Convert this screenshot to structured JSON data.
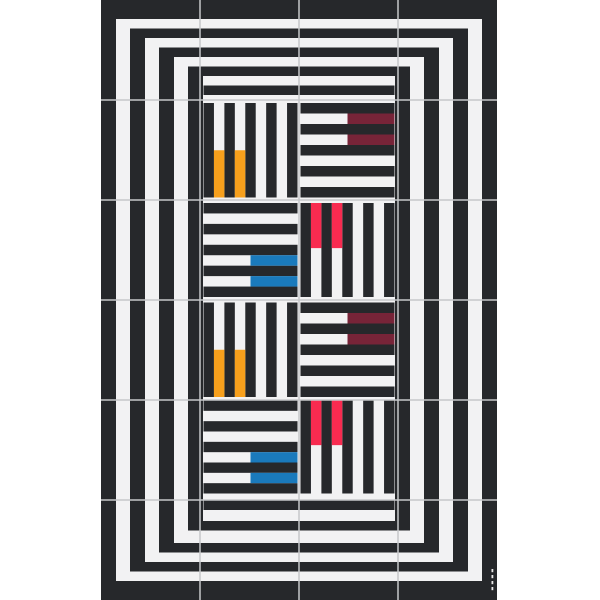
{
  "page": {
    "background": "#ffffff"
  },
  "artwork": {
    "left": 101,
    "top": 0,
    "width": 396,
    "height": 600,
    "colors": {
      "black": "#26282b",
      "white": "#f2f2f3",
      "seam": "#c6c8ca",
      "orange": "#f7a01c",
      "maroon": "#772438",
      "blue": "#1a7abc",
      "red": "#f82b50"
    },
    "grid": {
      "cols": 4,
      "rows": 6,
      "col_lines": [
        99,
        198,
        297
      ],
      "row_lines": [
        100,
        200,
        300,
        400,
        500
      ],
      "seam_width": 1.5
    },
    "frames": [
      {
        "x0": 0,
        "x1": 396,
        "y0": 0,
        "y1": 600,
        "leg_w": 15,
        "h_top": 19,
        "h_bot": 19
      },
      {
        "x0": 29,
        "x1": 367,
        "y0": 28.5,
        "y1": 571.5,
        "leg_w": 15,
        "h_top": 9.5,
        "h_bot": 9.5
      },
      {
        "x0": 58,
        "x1": 338,
        "y0": 47.5,
        "y1": 552.5,
        "leg_w": 15,
        "h_top": 9.5,
        "h_bot": 9.5
      },
      {
        "x0": 87,
        "x1": 309,
        "y0": 66.5,
        "y1": 530.5,
        "leg_w": 15,
        "h_top": 9.5,
        "h_bot": 9.5
      },
      {
        "x0": 102.5,
        "x1": 293.5,
        "y0": 85.5,
        "y1": 510,
        "leg_w": 0,
        "h_top": 9.5,
        "h_bot": 9.5
      }
    ],
    "tiles": [
      {
        "x": 102.5,
        "y": 103,
        "w": 94,
        "h": 94.5,
        "dir": "v",
        "bands": 9,
        "accent": {
          "color": "orange",
          "bands": [
            1,
            3
          ],
          "from": 0.5,
          "to": 1
        }
      },
      {
        "x": 199.5,
        "y": 103,
        "w": 94,
        "h": 94.5,
        "dir": "h",
        "bands": 9,
        "accent": {
          "color": "maroon",
          "bands": [
            1,
            3
          ],
          "from": 0.5,
          "to": 1
        }
      },
      {
        "x": 102.5,
        "y": 203,
        "w": 94,
        "h": 94,
        "dir": "h",
        "bands": 9,
        "accent": {
          "color": "blue",
          "bands": [
            5,
            7
          ],
          "from": 0.5,
          "to": 1
        }
      },
      {
        "x": 199.5,
        "y": 203,
        "w": 94,
        "h": 94,
        "dir": "v",
        "bands": 9,
        "accent": {
          "color": "red",
          "bands": [
            1,
            3
          ],
          "from": 0,
          "to": 0.48
        }
      },
      {
        "x": 102.5,
        "y": 302.5,
        "w": 94,
        "h": 94.5,
        "dir": "v",
        "bands": 9,
        "accent": {
          "color": "orange",
          "bands": [
            1,
            3
          ],
          "from": 0.5,
          "to": 1
        }
      },
      {
        "x": 199.5,
        "y": 302.5,
        "w": 94,
        "h": 94.5,
        "dir": "h",
        "bands": 9,
        "accent": {
          "color": "maroon",
          "bands": [
            1,
            3
          ],
          "from": 0.5,
          "to": 1
        }
      },
      {
        "x": 102.5,
        "y": 400.5,
        "w": 94,
        "h": 93,
        "dir": "h",
        "bands": 9,
        "accent": {
          "color": "blue",
          "bands": [
            5,
            7
          ],
          "from": 0.5,
          "to": 1
        }
      },
      {
        "x": 199.5,
        "y": 400.5,
        "w": 94,
        "h": 93,
        "dir": "v",
        "bands": 9,
        "accent": {
          "color": "red",
          "bands": [
            1,
            3
          ],
          "from": 0,
          "to": 0.48
        }
      }
    ],
    "signature": {
      "x": 390.5,
      "y": 569,
      "marks": 4,
      "gap": 6,
      "mark_w": 1.8,
      "mark_h": 3.2,
      "color": "#e9e9e9"
    }
  }
}
